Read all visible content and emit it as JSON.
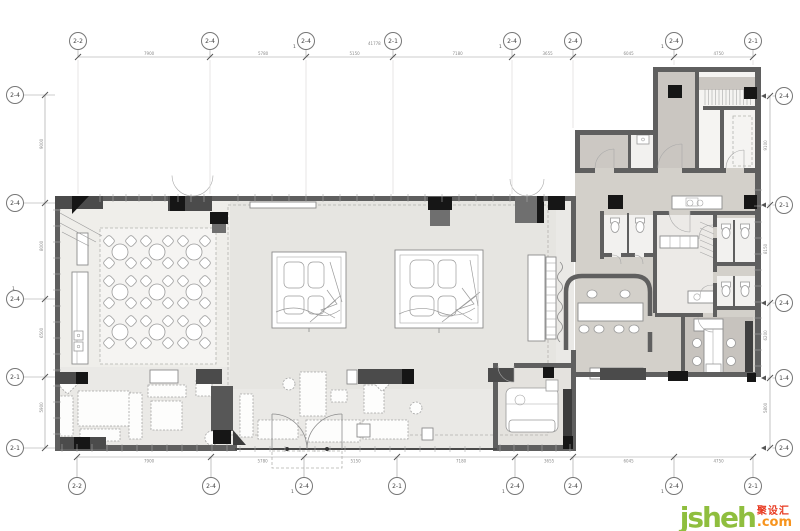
{
  "watermark": {
    "brand": "jsheh",
    "tld": ".com",
    "cn": "聚设汇"
  },
  "colors": {
    "wall": "#5f5f5f",
    "blk": "#161616",
    "furndark": "#4b4b4b",
    "ln": "#8c8c8c",
    "dash": "#b3b2af",
    "fbase": "#eae9e6",
    "fdining": "#efeeea",
    "fhall": "#e6e5e1",
    "carpet": "#f5f4f2",
    "fwing": "#d3d0ca",
    "fband": "#ccc8c3",
    "froomc": "#cac6c1",
    "foffice": "#c7c3be",
    "fvip": "#e4e2de",
    "wmgreen": "#8fbe3e",
    "wmorange": "#f7941d",
    "wmred": "#e83a21"
  },
  "plan": {
    "grid": {
      "top": {
        "cy": 41,
        "dim_y": 57,
        "items": [
          {
            "x": 78,
            "label": "2-2"
          },
          {
            "x": 210,
            "label": "2-4"
          },
          {
            "x": 306,
            "label": "2-4",
            "sub": "1"
          },
          {
            "x": 393,
            "label": "2-1"
          },
          {
            "x": 512,
            "label": "2-4",
            "sub": "1"
          },
          {
            "x": 573,
            "label": "2-4"
          },
          {
            "x": 674,
            "label": "2-4",
            "sub": "1"
          },
          {
            "x": 753,
            "label": "2-1"
          }
        ]
      },
      "bottom": {
        "cy": 486,
        "dim_y": 457,
        "items": [
          {
            "x": 77,
            "label": "2-2"
          },
          {
            "x": 211,
            "label": "2-4"
          },
          {
            "x": 304,
            "label": "2-4",
            "sub": "1"
          },
          {
            "x": 397,
            "label": "2-1"
          },
          {
            "x": 515,
            "label": "2-4",
            "sub": "1"
          },
          {
            "x": 573,
            "label": "2-4"
          },
          {
            "x": 674,
            "label": "2-4",
            "sub": "1"
          },
          {
            "x": 753,
            "label": "2-1"
          }
        ]
      },
      "left": {
        "cx": 15,
        "dim_x": 45,
        "items": [
          {
            "y": 95,
            "label": "2-4"
          },
          {
            "y": 203,
            "label": "2-4"
          },
          {
            "y": 299,
            "label": "2-4",
            "sub": "1"
          },
          {
            "y": 377,
            "label": "2-1"
          },
          {
            "y": 448,
            "label": "2-1"
          }
        ]
      },
      "right": {
        "cx": 784,
        "dim_x": 770,
        "items": [
          {
            "y": 96,
            "label": "2-4"
          },
          {
            "y": 205,
            "label": "2-1"
          },
          {
            "y": 303,
            "label": "2-4"
          },
          {
            "y": 378,
            "label": "1-4"
          },
          {
            "y": 448,
            "label": "2-4"
          }
        ]
      }
    },
    "dimensions": {
      "top_overall": "41778",
      "top_segments": [
        "7900",
        "5780",
        "5150",
        "7180",
        "3655",
        "6045",
        "4750"
      ],
      "bottom_segments": [
        "7900",
        "5780",
        "5150",
        "7180",
        "3655",
        "6045",
        "4750"
      ],
      "left_segments": [
        "9000",
        "8000",
        "6500",
        "5900"
      ],
      "right_segments": [
        "9100",
        "8150",
        "6200",
        "5800"
      ]
    },
    "dining_tables": {
      "cols": [
        120,
        157,
        194
      ],
      "rows": [
        252,
        292,
        332
      ],
      "table_r": 8,
      "chair_off": 11,
      "chair_s": 9
    },
    "toilets": [
      {
        "x": 615,
        "y": 226
      },
      {
        "x": 640,
        "y": 226
      },
      {
        "x": 726,
        "y": 232
      },
      {
        "x": 745,
        "y": 232
      },
      {
        "x": 726,
        "y": 290
      },
      {
        "x": 745,
        "y": 290
      }
    ],
    "conference_chairs": {
      "top_y": 294,
      "top_x": [
        592,
        625
      ],
      "bottom_y": 329,
      "bottom_x": [
        584,
        599,
        619,
        634
      ]
    },
    "office_chairs": [
      [
        697,
        343
      ],
      [
        697,
        361
      ],
      [
        731,
        343
      ],
      [
        731,
        361
      ]
    ],
    "lounge_furniture": [
      {
        "t": "r",
        "x": 60,
        "y": 376,
        "w": 15,
        "h": 15,
        "rot": 45
      },
      {
        "t": "r",
        "x": 57,
        "y": 396,
        "w": 16,
        "h": 40
      },
      {
        "t": "r",
        "x": 78,
        "y": 391,
        "w": 52,
        "h": 35
      },
      {
        "t": "r",
        "x": 80,
        "y": 429,
        "w": 40,
        "h": 12
      },
      {
        "t": "r",
        "x": 129,
        "y": 393,
        "w": 13,
        "h": 46
      },
      {
        "t": "r",
        "x": 148,
        "y": 385,
        "w": 38,
        "h": 12
      },
      {
        "t": "r",
        "x": 151,
        "y": 401,
        "w": 31,
        "h": 29
      },
      {
        "t": "r",
        "x": 196,
        "y": 379,
        "w": 16,
        "h": 17
      },
      {
        "t": "c",
        "x": 212,
        "y": 438,
        "r": 7
      },
      {
        "t": "r",
        "x": 240,
        "y": 394,
        "w": 13,
        "h": 43
      },
      {
        "t": "r",
        "x": 258,
        "y": 420,
        "w": 40,
        "h": 19
      },
      {
        "t": "r",
        "x": 300,
        "y": 372,
        "w": 26,
        "h": 44
      },
      {
        "t": "r",
        "x": 306,
        "y": 420,
        "w": 54,
        "h": 22
      },
      {
        "t": "r",
        "x": 331,
        "y": 390,
        "w": 16,
        "h": 12
      },
      {
        "t": "r",
        "x": 364,
        "y": 385,
        "w": 20,
        "h": 28
      },
      {
        "t": "r",
        "x": 363,
        "y": 420,
        "w": 45,
        "h": 19
      },
      {
        "t": "c",
        "x": 289,
        "y": 384,
        "r": 6
      },
      {
        "t": "r",
        "x": 376,
        "y": 377,
        "w": 12,
        "h": 12,
        "rot": 45
      },
      {
        "t": "c",
        "x": 416,
        "y": 408,
        "r": 6
      }
    ],
    "window_ticks": [
      {
        "o": "h",
        "at": 198,
        "from": 100,
        "to": 216,
        "step": 13,
        "len": 8
      },
      {
        "o": "h",
        "at": 198,
        "from": 238,
        "to": 545,
        "step": 17,
        "len": 8
      },
      {
        "o": "v",
        "at": 57,
        "from": 210,
        "to": 444,
        "step": 16,
        "len": 8
      },
      {
        "o": "h",
        "at": 448,
        "from": 62,
        "to": 232,
        "step": 15,
        "len": 8
      },
      {
        "o": "h",
        "at": 449,
        "from": 240,
        "to": 494,
        "step": 15,
        "len": 6
      },
      {
        "o": "h",
        "at": 448,
        "from": 500,
        "to": 572,
        "step": 14,
        "len": 8
      },
      {
        "o": "v",
        "at": 758,
        "from": 190,
        "to": 366,
        "step": 16,
        "len": 8
      },
      {
        "o": "v",
        "at": 551,
        "from": 263,
        "to": 337,
        "step": 8,
        "len": 10
      }
    ],
    "stair_treads": {
      "x1": 705,
      "x2": 751,
      "y": 89,
      "h": 16,
      "step": 3.5
    },
    "shaft_hatch": {
      "x": 700,
      "y": 222,
      "w": 14,
      "h": 38,
      "step": 6
    }
  }
}
